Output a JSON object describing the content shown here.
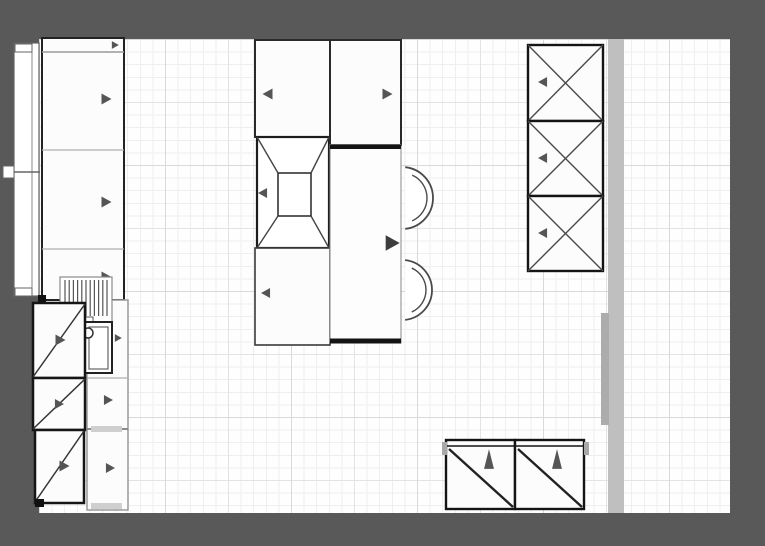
{
  "canvas": {
    "w": 765,
    "h": 546,
    "frame_color": "#595959"
  },
  "floor": {
    "x": 39,
    "y": 39,
    "w": 691,
    "h": 474,
    "fill": "#fefefe",
    "grid": {
      "minor": 12.6,
      "minor_color": "#efefef",
      "mid": 63,
      "mid_color": "#e3e3e3",
      "major": 126,
      "major_color": "#d9d9d9"
    }
  },
  "palette": {
    "line": "#1b1b1b",
    "soft": "#8f8f8f",
    "arrow": "#555555",
    "arrow_dark": "#3d3d3d",
    "wall": "#bfbfbf",
    "wall_dark": "#acacac",
    "cabinet_fill": "#fcfcfc"
  },
  "items": [
    {
      "name": "right-wall-strip",
      "interactable": false,
      "parts": [
        {
          "t": "rect",
          "x": 608,
          "y": 39,
          "w": 16,
          "h": 474,
          "f": "#bfbfbf",
          "s": "none"
        }
      ]
    },
    {
      "name": "right-wall-segment",
      "interactable": false,
      "parts": [
        {
          "t": "rect",
          "x": 601,
          "y": 313,
          "w": 8,
          "h": 112,
          "f": "#acacac",
          "s": "none"
        }
      ]
    },
    {
      "name": "left-window",
      "interactable": true,
      "parts": [
        {
          "t": "rect",
          "x": 14,
          "y": 43,
          "w": 25,
          "h": 253,
          "f": "#ffffff",
          "s": "#666",
          "sw": 1.2
        },
        {
          "t": "line",
          "x1": 32,
          "y1": 45,
          "x2": 32,
          "y2": 294,
          "s": "#888",
          "sw": 1
        },
        {
          "t": "rect",
          "x": 15,
          "y": 44,
          "w": 17,
          "h": 8,
          "f": "#ffffff",
          "s": "#666",
          "sw": 1
        },
        {
          "t": "rect",
          "x": 15,
          "y": 288,
          "w": 17,
          "h": 8,
          "f": "#ffffff",
          "s": "#666",
          "sw": 1
        },
        {
          "t": "rect",
          "x": 3,
          "y": 166,
          "w": 11,
          "h": 12,
          "f": "#ffffff",
          "s": "#666",
          "sw": 1
        },
        {
          "t": "line",
          "x1": 14,
          "y1": 172,
          "x2": 40,
          "y2": 172,
          "s": "#666",
          "sw": 1.5
        }
      ]
    },
    {
      "name": "pantry-run-left",
      "interactable": true,
      "parts": [
        {
          "t": "rect",
          "x": 42,
          "y": 38,
          "w": 82,
          "h": 262,
          "f": "#fcfcfc",
          "s": "#222",
          "sw": 2
        },
        {
          "t": "line",
          "x1": 42,
          "y1": 52,
          "x2": 124,
          "y2": 52,
          "s": "#999",
          "sw": 1.5
        },
        {
          "t": "line",
          "x1": 42,
          "y1": 150,
          "x2": 124,
          "y2": 150,
          "s": "#b0b0b0",
          "sw": 1.2
        },
        {
          "t": "line",
          "x1": 42,
          "y1": 249,
          "x2": 124,
          "y2": 249,
          "s": "#b0b0b0",
          "sw": 1.2
        },
        {
          "t": "tri",
          "cx": 115,
          "cy": 45,
          "sz": 7,
          "dir": "right"
        },
        {
          "t": "tri",
          "cx": 106,
          "cy": 99,
          "sz": 10,
          "dir": "right"
        },
        {
          "t": "tri",
          "cx": 106,
          "cy": 202,
          "sz": 10,
          "dir": "right"
        },
        {
          "t": "tri",
          "cx": 106,
          "cy": 277,
          "sz": 10,
          "dir": "right"
        }
      ]
    },
    {
      "name": "base-cabinet-column-left",
      "interactable": true,
      "parts": [
        {
          "t": "rect",
          "x": 87,
          "y": 300,
          "w": 41,
          "h": 210,
          "f": "#fcfcfc",
          "s": "#9a9a9a",
          "sw": 1.5
        },
        {
          "t": "line",
          "x1": 87,
          "y1": 378,
          "x2": 128,
          "y2": 378,
          "s": "#b0b0b0",
          "sw": 1.2
        },
        {
          "t": "line",
          "x1": 87,
          "y1": 429,
          "x2": 128,
          "y2": 429,
          "s": "#8a8a8a",
          "sw": 2
        },
        {
          "t": "rect",
          "x": 91,
          "y": 426,
          "w": 31,
          "h": 6,
          "f": "#cfcfcf",
          "s": "none"
        },
        {
          "t": "rect",
          "x": 91,
          "y": 503,
          "w": 31,
          "h": 6,
          "f": "#cfcfcf",
          "s": "none"
        },
        {
          "t": "tri",
          "cx": 118,
          "cy": 338,
          "sz": 7,
          "dir": "right"
        },
        {
          "t": "tri",
          "cx": 108,
          "cy": 400,
          "sz": 9,
          "dir": "right"
        },
        {
          "t": "tri",
          "cx": 110,
          "cy": 468,
          "sz": 9,
          "dir": "right"
        }
      ]
    },
    {
      "name": "dish-rack",
      "interactable": true,
      "parts": [
        {
          "t": "rect",
          "x": 60,
          "y": 277,
          "w": 52,
          "h": 55,
          "f": "#ffffff",
          "s": "#8a8a8a",
          "sw": 1.2
        },
        {
          "t": "vlines",
          "x": 65,
          "y": 280,
          "w": 42,
          "h": 36,
          "n": 11,
          "s": "#555",
          "sw": 1.2
        },
        {
          "t": "rect",
          "x": 84,
          "y": 317,
          "w": 9,
          "h": 7,
          "f": "#ffffff",
          "s": "#555",
          "sw": 1
        }
      ]
    },
    {
      "name": "sink",
      "interactable": true,
      "parts": [
        {
          "t": "rect",
          "x": 85,
          "y": 322,
          "w": 27,
          "h": 51,
          "f": "#ffffff",
          "s": "#222",
          "sw": 2
        },
        {
          "t": "rect",
          "x": 89,
          "y": 327,
          "w": 19,
          "h": 42,
          "s": "#666",
          "sw": 1.2
        },
        {
          "t": "circle",
          "cx": 88,
          "cy": 333,
          "r": 5,
          "f": "#ffffff",
          "s": "#333",
          "sw": 1.5
        }
      ]
    },
    {
      "name": "corner-cabinet-top",
      "interactable": true,
      "parts": [
        {
          "t": "rect",
          "x": 38,
          "y": 295,
          "w": 8,
          "h": 7,
          "f": "#111111",
          "s": "none"
        },
        {
          "t": "rect",
          "x": 33,
          "y": 303,
          "w": 52,
          "h": 75,
          "f": "#fcfcfc",
          "s": "#161616",
          "sw": 2.5
        },
        {
          "t": "line",
          "x1": 33,
          "y1": 377,
          "x2": 85,
          "y2": 304,
          "s": "#333",
          "sw": 1.5
        },
        {
          "t": "tri",
          "cx": 60,
          "cy": 340,
          "sz": 10,
          "dir": "right"
        }
      ]
    },
    {
      "name": "corner-cabinet-middle",
      "interactable": true,
      "parts": [
        {
          "t": "rect",
          "x": 33,
          "y": 378,
          "w": 52,
          "h": 52,
          "f": "#fcfcfc",
          "s": "#161616",
          "sw": 2.5
        },
        {
          "t": "line",
          "x1": 33,
          "y1": 429,
          "x2": 85,
          "y2": 379,
          "s": "#333",
          "sw": 1.5
        },
        {
          "t": "tri",
          "cx": 59,
          "cy": 404,
          "sz": 9,
          "dir": "right"
        }
      ]
    },
    {
      "name": "corner-cabinet-bottom",
      "interactable": true,
      "parts": [
        {
          "t": "rect",
          "x": 35,
          "y": 430,
          "w": 49,
          "h": 73,
          "f": "#fcfcfc",
          "s": "#161616",
          "sw": 2.5
        },
        {
          "t": "line",
          "x1": 35,
          "y1": 502,
          "x2": 84,
          "y2": 431,
          "s": "#333",
          "sw": 1.5
        },
        {
          "t": "tri",
          "cx": 64,
          "cy": 466,
          "sz": 10,
          "dir": "right"
        },
        {
          "t": "rect",
          "x": 35,
          "y": 499,
          "w": 9,
          "h": 8,
          "f": "#111111",
          "s": "none"
        }
      ]
    },
    {
      "name": "island-cabinet-top-left",
      "interactable": true,
      "parts": [
        {
          "t": "rect",
          "x": 255,
          "y": 40,
          "w": 75,
          "h": 97,
          "f": "#fcfcfc",
          "s": "#2a2a2a",
          "sw": 2
        },
        {
          "t": "tri",
          "cx": 268,
          "cy": 94,
          "sz": 10,
          "dir": "left"
        }
      ]
    },
    {
      "name": "island-extractor-hood",
      "interactable": true,
      "parts": [
        {
          "t": "rect",
          "x": 257,
          "y": 137,
          "w": 72,
          "h": 111,
          "f": "#ffffff",
          "s": "#1d1d1d",
          "sw": 2.2
        },
        {
          "t": "rect",
          "x": 278,
          "y": 173,
          "w": 33,
          "h": 43,
          "f": "#ffffff",
          "s": "#333",
          "sw": 1.6
        },
        {
          "t": "line",
          "x1": 257,
          "y1": 137,
          "x2": 278,
          "y2": 173,
          "s": "#444",
          "sw": 1.4
        },
        {
          "t": "line",
          "x1": 329,
          "y1": 137,
          "x2": 311,
          "y2": 173,
          "s": "#444",
          "sw": 1.4
        },
        {
          "t": "line",
          "x1": 257,
          "y1": 248,
          "x2": 278,
          "y2": 216,
          "s": "#444",
          "sw": 1.4
        },
        {
          "t": "line",
          "x1": 329,
          "y1": 248,
          "x2": 311,
          "y2": 216,
          "s": "#444",
          "sw": 1.4
        },
        {
          "t": "tri",
          "cx": 263,
          "cy": 193,
          "sz": 9,
          "dir": "left"
        }
      ]
    },
    {
      "name": "island-cabinet-bottom-left",
      "interactable": true,
      "parts": [
        {
          "t": "rect",
          "x": 255,
          "y": 248,
          "w": 75,
          "h": 97,
          "f": "#fcfcfc",
          "s": "#3a3a3a",
          "sw": 1.6
        },
        {
          "t": "tri",
          "cx": 266,
          "cy": 293,
          "sz": 9,
          "dir": "left"
        }
      ]
    },
    {
      "name": "island-cabinet-top-right",
      "interactable": true,
      "parts": [
        {
          "t": "rect",
          "x": 330,
          "y": 40,
          "w": 71,
          "h": 105,
          "f": "#fcfcfc",
          "s": "#2a2a2a",
          "sw": 2
        },
        {
          "t": "tri",
          "cx": 387,
          "cy": 94,
          "sz": 10,
          "dir": "right"
        }
      ]
    },
    {
      "name": "bar-stool-top",
      "interactable": true,
      "parts": [
        {
          "t": "arc",
          "cx": 402,
          "cy": 198,
          "r": 31,
          "a1": -84,
          "a2": 84,
          "f": "#ffffff",
          "s": "#4a4a4a",
          "sw": 1.8
        },
        {
          "t": "arc",
          "cx": 402,
          "cy": 198,
          "r": 25,
          "a1": -66,
          "a2": 66,
          "s": "#4a4a4a",
          "sw": 1.4
        }
      ]
    },
    {
      "name": "bar-stool-bottom",
      "interactable": true,
      "parts": [
        {
          "t": "arc",
          "cx": 402,
          "cy": 290,
          "r": 30,
          "a1": -84,
          "a2": 84,
          "f": "#ffffff",
          "s": "#4a4a4a",
          "sw": 1.8
        },
        {
          "t": "arc",
          "cx": 402,
          "cy": 290,
          "r": 24,
          "a1": -66,
          "a2": 66,
          "s": "#4a4a4a",
          "sw": 1.4
        }
      ]
    },
    {
      "name": "island-bar-counter",
      "interactable": true,
      "parts": [
        {
          "t": "rect",
          "x": 330,
          "y": 145,
          "w": 71,
          "h": 198,
          "f": "#fdfdfd",
          "s": "#888",
          "sw": 1
        },
        {
          "t": "line",
          "x1": 330,
          "y1": 147,
          "x2": 401,
          "y2": 147,
          "s": "#141414",
          "sw": 4
        },
        {
          "t": "line",
          "x1": 330,
          "y1": 341,
          "x2": 401,
          "y2": 341,
          "s": "#141414",
          "sw": 5
        },
        {
          "t": "tri",
          "cx": 392,
          "cy": 243,
          "sz": 14,
          "dir": "right",
          "f": "#3d3d3d"
        }
      ]
    },
    {
      "name": "tall-cabinet-right-top",
      "interactable": true,
      "parts": [
        {
          "t": "rect",
          "x": 528,
          "y": 45,
          "w": 75,
          "h": 76,
          "f": "#fcfcfc",
          "s": "#141414",
          "sw": 2.4
        },
        {
          "t": "line",
          "x1": 528,
          "y1": 45,
          "x2": 603,
          "y2": 121,
          "s": "#4a4a4a",
          "sw": 1.4
        },
        {
          "t": "line",
          "x1": 603,
          "y1": 45,
          "x2": 528,
          "y2": 121,
          "s": "#4a4a4a",
          "sw": 1.4
        },
        {
          "t": "tri",
          "cx": 543,
          "cy": 82,
          "sz": 9,
          "dir": "left"
        }
      ]
    },
    {
      "name": "tall-cabinet-right-middle",
      "interactable": true,
      "parts": [
        {
          "t": "rect",
          "x": 528,
          "y": 121,
          "w": 75,
          "h": 75,
          "f": "#fcfcfc",
          "s": "#141414",
          "sw": 2.4
        },
        {
          "t": "line",
          "x1": 528,
          "y1": 121,
          "x2": 603,
          "y2": 196,
          "s": "#4a4a4a",
          "sw": 1.4
        },
        {
          "t": "line",
          "x1": 603,
          "y1": 121,
          "x2": 528,
          "y2": 196,
          "s": "#4a4a4a",
          "sw": 1.4
        },
        {
          "t": "tri",
          "cx": 543,
          "cy": 158,
          "sz": 9,
          "dir": "left"
        }
      ]
    },
    {
      "name": "tall-cabinet-right-bottom",
      "interactable": true,
      "parts": [
        {
          "t": "rect",
          "x": 528,
          "y": 196,
          "w": 75,
          "h": 75,
          "f": "#fcfcfc",
          "s": "#141414",
          "sw": 2.4
        },
        {
          "t": "line",
          "x1": 528,
          "y1": 196,
          "x2": 603,
          "y2": 271,
          "s": "#4a4a4a",
          "sw": 1.4
        },
        {
          "t": "line",
          "x1": 603,
          "y1": 196,
          "x2": 528,
          "y2": 271,
          "s": "#4a4a4a",
          "sw": 1.4
        },
        {
          "t": "tri",
          "cx": 543,
          "cy": 233,
          "sz": 9,
          "dir": "left"
        }
      ]
    },
    {
      "name": "bottom-cabinet-left",
      "interactable": true,
      "parts": [
        {
          "t": "rect",
          "x": 446,
          "y": 440,
          "w": 69,
          "h": 69,
          "f": "#fcfcfc",
          "s": "#141414",
          "sw": 2.4
        },
        {
          "t": "line",
          "x1": 446,
          "y1": 446,
          "x2": 515,
          "y2": 446,
          "s": "#141414",
          "sw": 1.6
        },
        {
          "t": "line",
          "x1": 449,
          "y1": 449,
          "x2": 513,
          "y2": 507,
          "s": "#222",
          "sw": 2.4
        },
        {
          "t": "tri",
          "cx": 489,
          "cy": 459,
          "sz": 11,
          "dir": "up"
        }
      ]
    },
    {
      "name": "bottom-cabinet-right",
      "interactable": true,
      "parts": [
        {
          "t": "rect",
          "x": 515,
          "y": 440,
          "w": 69,
          "h": 69,
          "f": "#fcfcfc",
          "s": "#141414",
          "sw": 2.4
        },
        {
          "t": "line",
          "x1": 515,
          "y1": 446,
          "x2": 584,
          "y2": 446,
          "s": "#141414",
          "sw": 1.6
        },
        {
          "t": "line",
          "x1": 518,
          "y1": 449,
          "x2": 582,
          "y2": 507,
          "s": "#222",
          "sw": 2.4
        },
        {
          "t": "tri",
          "cx": 557,
          "cy": 459,
          "sz": 11,
          "dir": "up"
        }
      ]
    },
    {
      "name": "counter-end-tabs",
      "interactable": false,
      "parts": [
        {
          "t": "rect",
          "x": 442,
          "y": 442,
          "w": 5,
          "h": 13,
          "f": "#a8a8a8",
          "s": "none"
        },
        {
          "t": "rect",
          "x": 584,
          "y": 442,
          "w": 5,
          "h": 13,
          "f": "#a8a8a8",
          "s": "none"
        }
      ]
    }
  ]
}
